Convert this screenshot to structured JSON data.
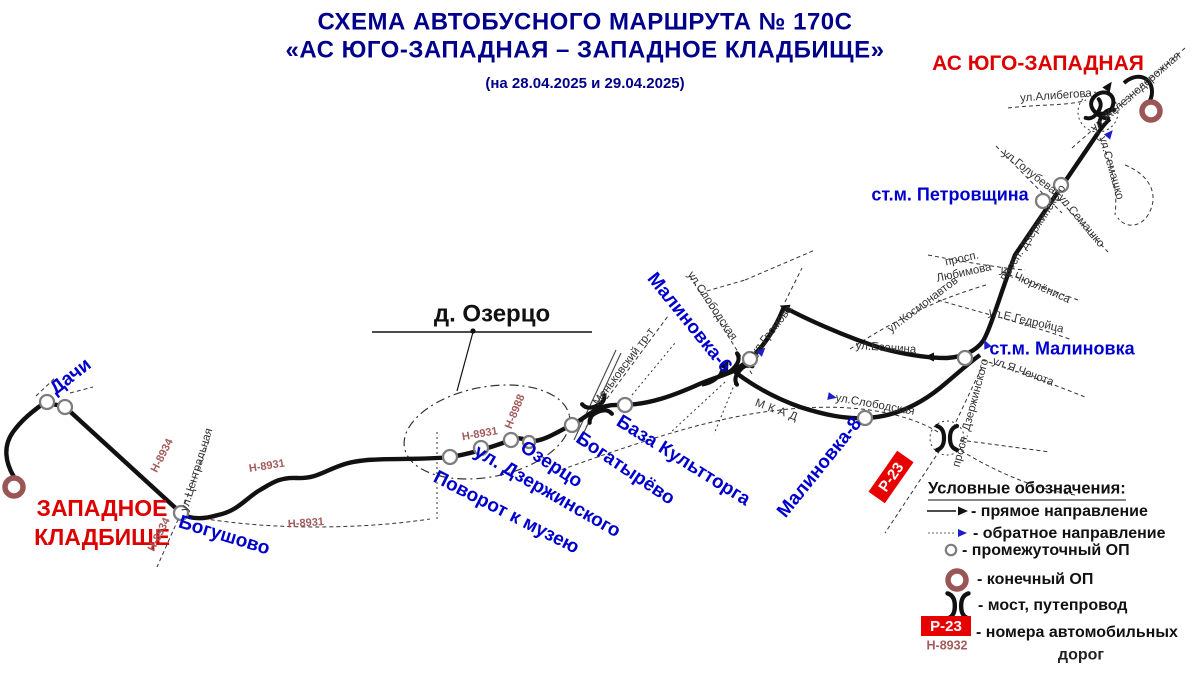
{
  "title": {
    "line1": "СХЕМА АВТОБУСНОГО МАРШРУТА № 170С",
    "line2": "«АС ЮГО-ЗАПАДНАЯ – ЗАПАДНОЕ КЛАДБИЩЕ»",
    "dates": "(на 28.04.2025 и 29.04.2025)"
  },
  "terminals": {
    "as_yugo_zapadnaya": "АС ЮГО-ЗАПАДНАЯ",
    "zapadnoe_line1": "ЗАПАДНОЕ",
    "zapadnoe_line2": "КЛАДБИЩЕ"
  },
  "stops": {
    "dachi": "Дачи",
    "bogushovo": "Богушово",
    "povorot_k_muzeyu": "Поворот к музею",
    "ul_dzerzhinskogo": "ул. Дзержинского",
    "ozertso": "Озерцо",
    "bogatyrevo": "Богатырёво",
    "baza_kulttorga": "База Культторга",
    "malinovka6": "Малиновка-6",
    "malinovka8": "Малиновка-8",
    "st_m_malinovka": "ст.м. Малиновка",
    "st_m_petrovshchina": "ст.м. Петровщина"
  },
  "places": {
    "d_ozertso": "д. Озерцо"
  },
  "streets": {
    "tsentralnaya": "ул.Центральная",
    "menkovsky": "Меньковский тр-т",
    "slobodskaya": "ул.Слободская",
    "gromova": "ул.Громова",
    "mkad": "МКАД",
    "esenina": "ул.Есенина",
    "kosmonavtov": "ул.Космонавтов",
    "gedroitsa": "ул.Е.Гедройца",
    "chechota": "ул.Я.Чечота",
    "dzerzhinskogo_prosp": "просп. Дзержинского",
    "lyubimova1": "просп.",
    "lyubimova2": "Любимова",
    "churlenisa": "ул.Чюрлёниса",
    "golubeva": "ул.Голубева",
    "semashko": "ул.Семашко",
    "alibegova": "ул.Алибегова",
    "zheleznodorozhnaya": "ул.Железнодорожная"
  },
  "road_numbers": {
    "r23": "Р-23",
    "h8931": "Н-8931",
    "h8934": "Н-8934",
    "h8988": "Н-8988",
    "h8932": "Н-8932"
  },
  "legend": {
    "title": "Условные обозначения:",
    "direct": "- прямое направление",
    "reverse": "- обратное направление",
    "intermediate": "- промежуточный ОП",
    "terminal": "- конечный ОП",
    "bridge": "- мост, путепровод",
    "road_numbers_line1": "- номера автомобильных",
    "road_numbers_line2": "дорог"
  }
}
